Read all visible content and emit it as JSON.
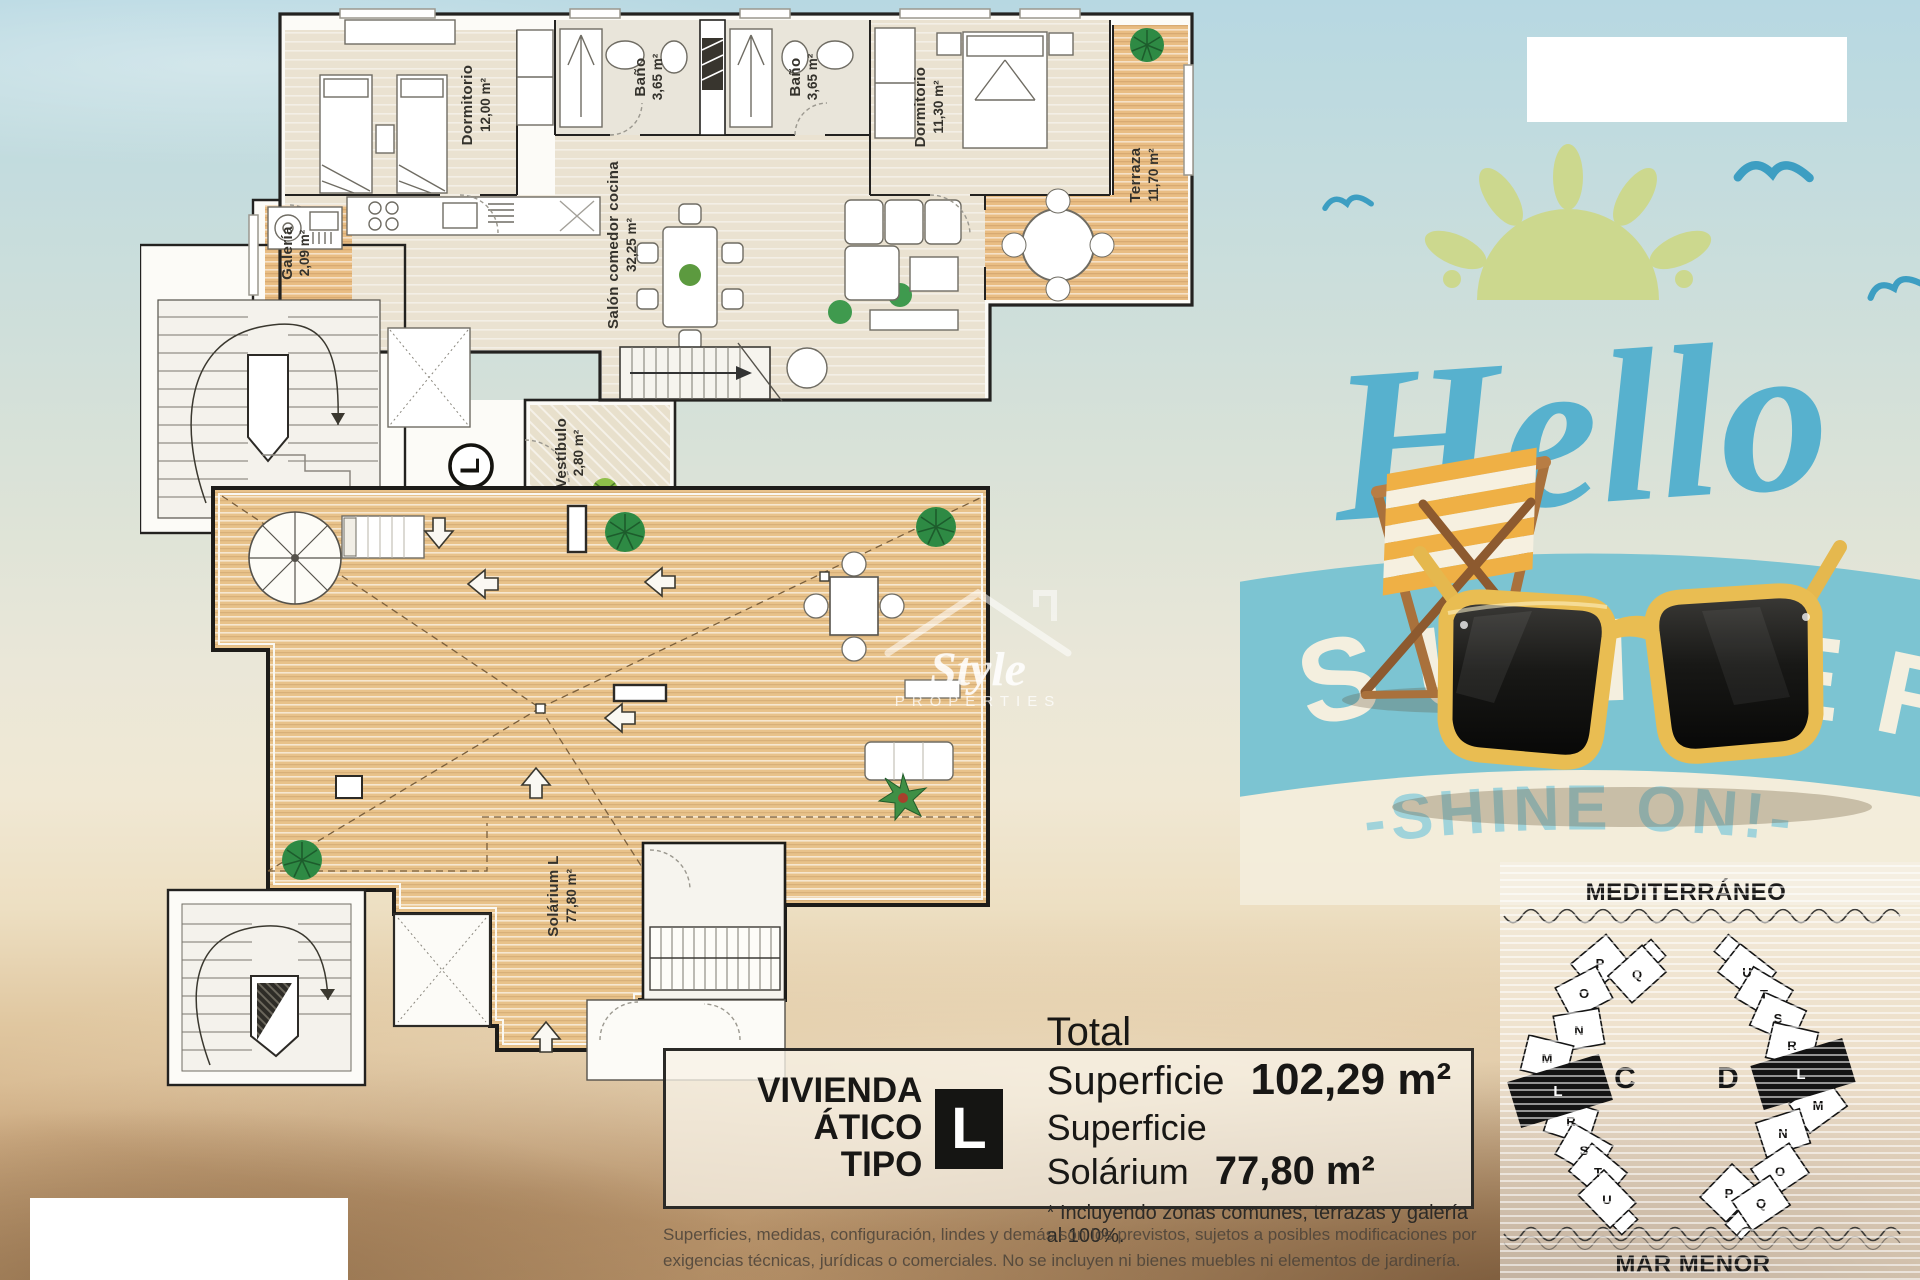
{
  "upper_plan": {
    "rooms": {
      "dorm1": {
        "name": "Dormitorio",
        "area": "12,00 m²"
      },
      "bath1": {
        "name": "Baño",
        "area": "3,65 m²"
      },
      "bath2": {
        "name": "Baño",
        "area": "3,65 m²"
      },
      "dorm2": {
        "name": "Dormitorio",
        "area": "11,30 m²"
      },
      "terrace": {
        "name": "Terraza",
        "area": "11,70 m²"
      },
      "galeria": {
        "name": "Galería",
        "area": "2,09 m²"
      },
      "salon": {
        "name": "Salón comedor cocina",
        "area": "32,25 m²"
      },
      "vestibulo": {
        "name": "Vestíbulo",
        "area": "2,80 m²"
      }
    },
    "unit_marker": "L"
  },
  "lower_plan": {
    "solarium": {
      "name": "Solárium L",
      "area": "77,80 m²"
    }
  },
  "watermark": {
    "brand": "Style",
    "sub": "PROPERTIES"
  },
  "hero": {
    "hello": "Hello",
    "summer": [
      "S",
      "U",
      "M",
      "M",
      "E",
      "R"
    ],
    "shine": "-SHINE ON!-"
  },
  "info_box": {
    "title_line1": "VIVIENDA",
    "title_line2": "ÁTICO TIPO",
    "type_letter": "L",
    "total_label": "Total Superficie",
    "total_value": "102,29 m²",
    "solarium_label": "Superficie Solárium",
    "solarium_value": "77,80 m²",
    "note": "* Incluyendo zonas comunes, terrazas y galería al 100%."
  },
  "disclaimer": {
    "line1": "Superficies, medidas, configuración, lindes y demás son los previstos, sujetos a posibles modificaciones por",
    "line2": "exigencias técnicas, jurídicas o comerciales. No se incluyen ni bienes muebles ni elementos de jardinería."
  },
  "site_map": {
    "sea_top": "MEDITERRÁNEO",
    "sea_bottom": "MAR MENOR",
    "block_c": {
      "label": "C",
      "units": [
        "P",
        "Q",
        "O",
        "N",
        "M",
        "L",
        "R",
        "S",
        "T",
        "U"
      ]
    },
    "block_d": {
      "label": "D",
      "units": [
        "U",
        "T",
        "S",
        "R",
        "L",
        "M",
        "N",
        "O",
        "P",
        "Q"
      ]
    }
  },
  "colors": {
    "accent_blue": "#57b1ce",
    "band_blue": "#7cc4d2",
    "sun_green": "#ccd88e",
    "frame_yellow": "#e9bd52"
  }
}
